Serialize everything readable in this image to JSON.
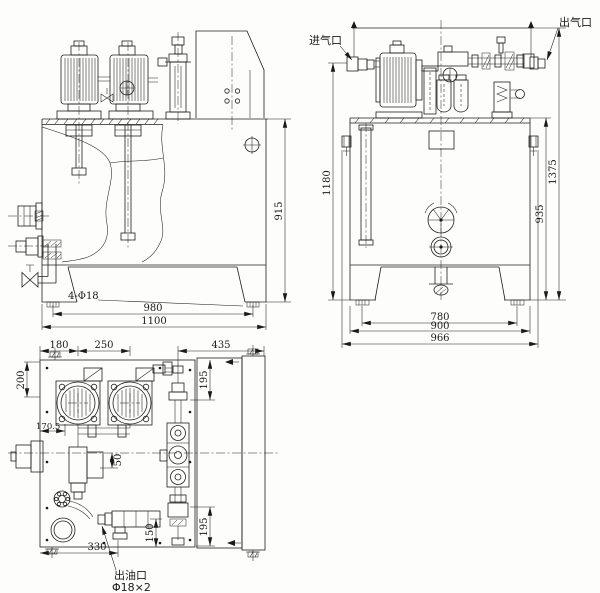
{
  "palette": {
    "line": "#1f1f1f",
    "paper": "#fdfdfc"
  },
  "views": {
    "front": {
      "dims": {
        "holes": "4-Φ18",
        "width_feet": "980",
        "width_overall": "1100",
        "height": "915"
      }
    },
    "side": {
      "labels": {
        "air_inlet": "进气口",
        "air_outlet": "出气口"
      },
      "dims": {
        "pipe_height": "1180",
        "overall_height": "1375",
        "tank_height": "935",
        "feet_width": "780",
        "tank_width": "900",
        "overall_width": "966"
      }
    },
    "plan": {
      "labels": {
        "oil_outlet": "出油口",
        "oil_outlet_spec": "Φ18×2"
      },
      "dims": {
        "motor1_x": "180",
        "motor_spacing": "250",
        "right_width": "435",
        "left_depth": "200",
        "ref_width": "170.5",
        "pump_offset": "50",
        "top_right_depth": "195",
        "bottom_right_depth": "195",
        "outlet_depth": "150",
        "outlet_x": "330"
      }
    }
  }
}
